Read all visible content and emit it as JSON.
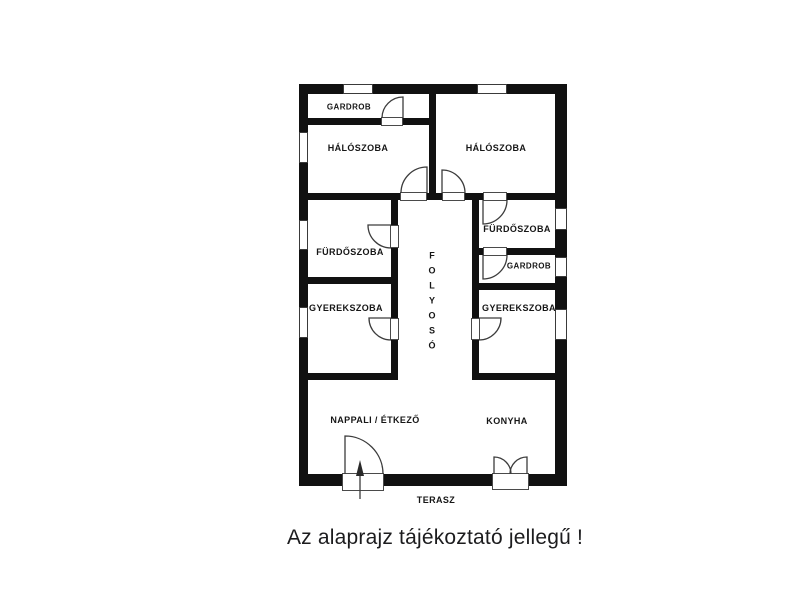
{
  "rooms": {
    "gardrob_left": "GARDROB",
    "haloszoba_left": "HÁLÓSZOBA",
    "haloszoba_right": "HÁLÓSZOBA",
    "furdoszoba_left": "FÜRDŐSZOBA",
    "furdoszoba_right": "FÜRDŐSZOBA",
    "gardrob_right": "GARDROB",
    "gyerekszoba_left": "GYEREKSZOBA",
    "gyerekszoba_right": "GYEREKSZOBA",
    "folyoso": "FOLYOSÓ",
    "nappali_etkezo": "NAPPALI / ÉTKEZŐ",
    "konyha": "KONYHA",
    "terasz": "TERASZ"
  },
  "caption": "Az alaprajz tájékoztató jellegű !",
  "colors": {
    "wall": "#111111",
    "door_line": "#3c3c3c",
    "background": "#ffffff",
    "caption_text": "#1c1c1e"
  }
}
